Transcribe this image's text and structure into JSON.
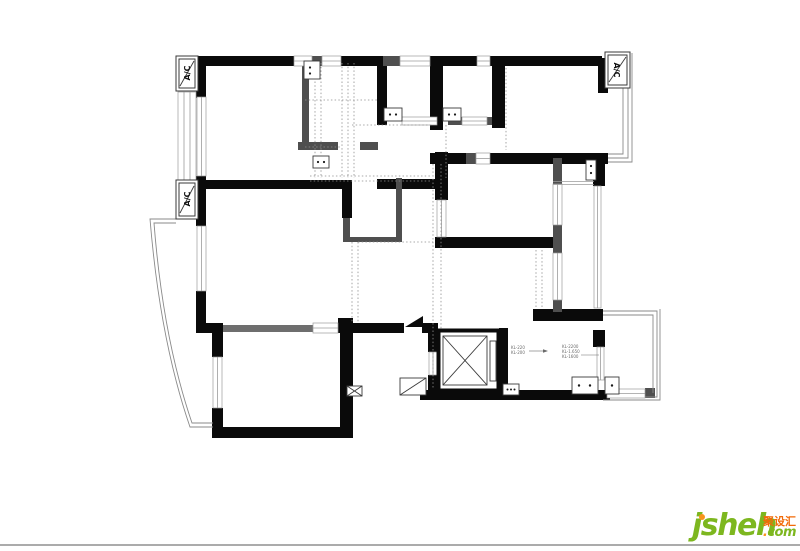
{
  "colors": {
    "background": "#ffffff",
    "wall": "#0a0a0a",
    "partition": "#4f4f4f",
    "rail": "#6e6e6e",
    "window_line": "#9b9b9b",
    "dotted": "#8f8f8f",
    "balcony": "#8a8a8a",
    "annotation": "#6a6a6a",
    "divider": "#ababab",
    "logo_green": "#7db71f",
    "logo_orange": "#f7941d",
    "logo_red": "#f26a07"
  },
  "plan": {
    "ac_units": [
      {
        "label": "A/C"
      },
      {
        "label": "A/C"
      },
      {
        "label": "A/C"
      }
    ],
    "annotations": {
      "left_lines": [
        "KL-220",
        "KL-200"
      ],
      "right_lines": [
        "KL-2200",
        "KL-1.650",
        "KL-1600"
      ]
    }
  },
  "watermark": {
    "brand": "jsheh",
    "dot": ".",
    "tld": "com",
    "chinese": "聚设汇"
  }
}
